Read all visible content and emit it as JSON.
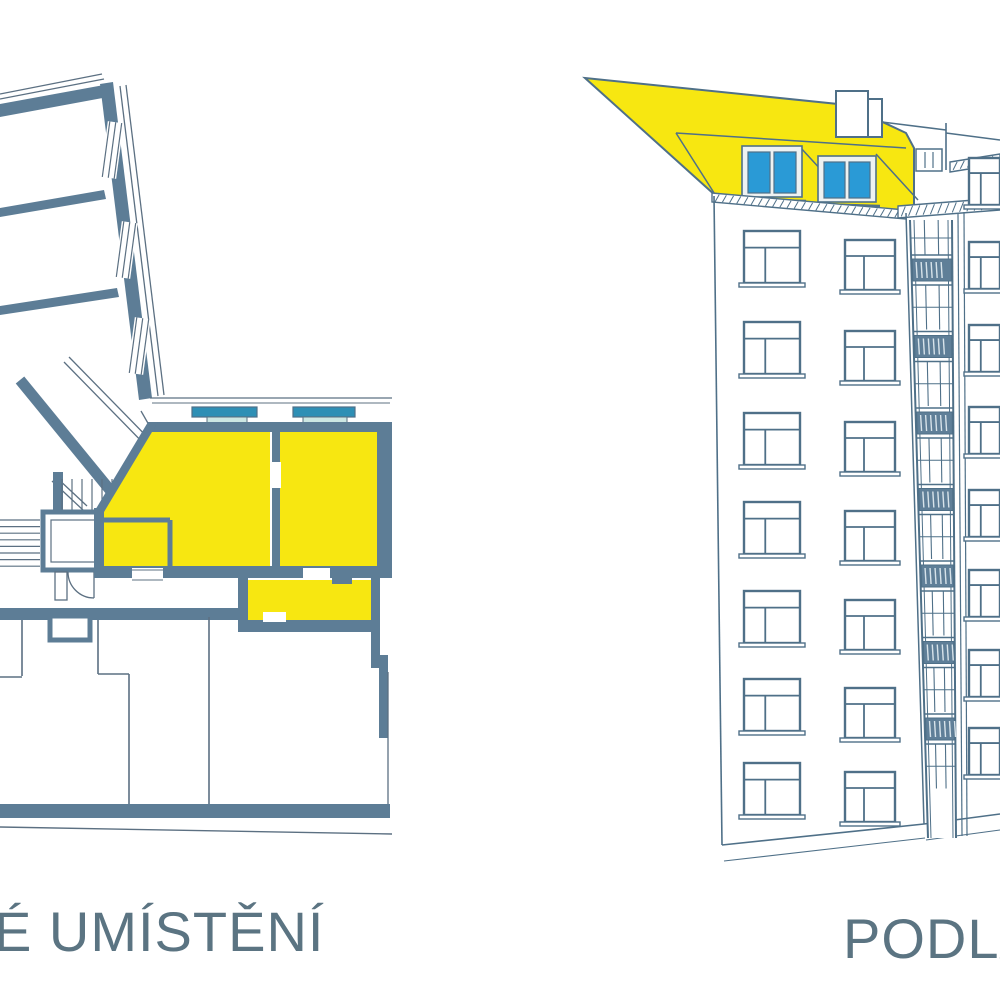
{
  "captions": {
    "left": "É UMÍSTĚNÍ",
    "right": "PODLA",
    "color": "#5b7482"
  },
  "palette": {
    "wall": "#5d7d96",
    "outline": "#4f7088",
    "thin_line": "#5c7082",
    "highlight_yellow": "#f7e711",
    "dormer_glass": "#2a9ad6",
    "window_bar_teal": "#2e8fb5",
    "window_bar_inner": "#cde7e3",
    "railing": "#5f7f98",
    "facade": "#ffffff"
  },
  "floor_plan": {
    "name": "floor-plan",
    "highlighted_room_count": 3,
    "terrace_window_bars": 2,
    "has_staircase": true,
    "has_elevator": true,
    "upper_wing_windows": 3
  },
  "building": {
    "name": "building-elevation",
    "attic_highlighted": true,
    "dormer_windows": 2,
    "has_chimney": true,
    "left_facade": {
      "rows": 7,
      "cols": 2
    },
    "right_facade": {
      "rows": 8,
      "cols": 1
    },
    "balcony_levels": 7
  }
}
